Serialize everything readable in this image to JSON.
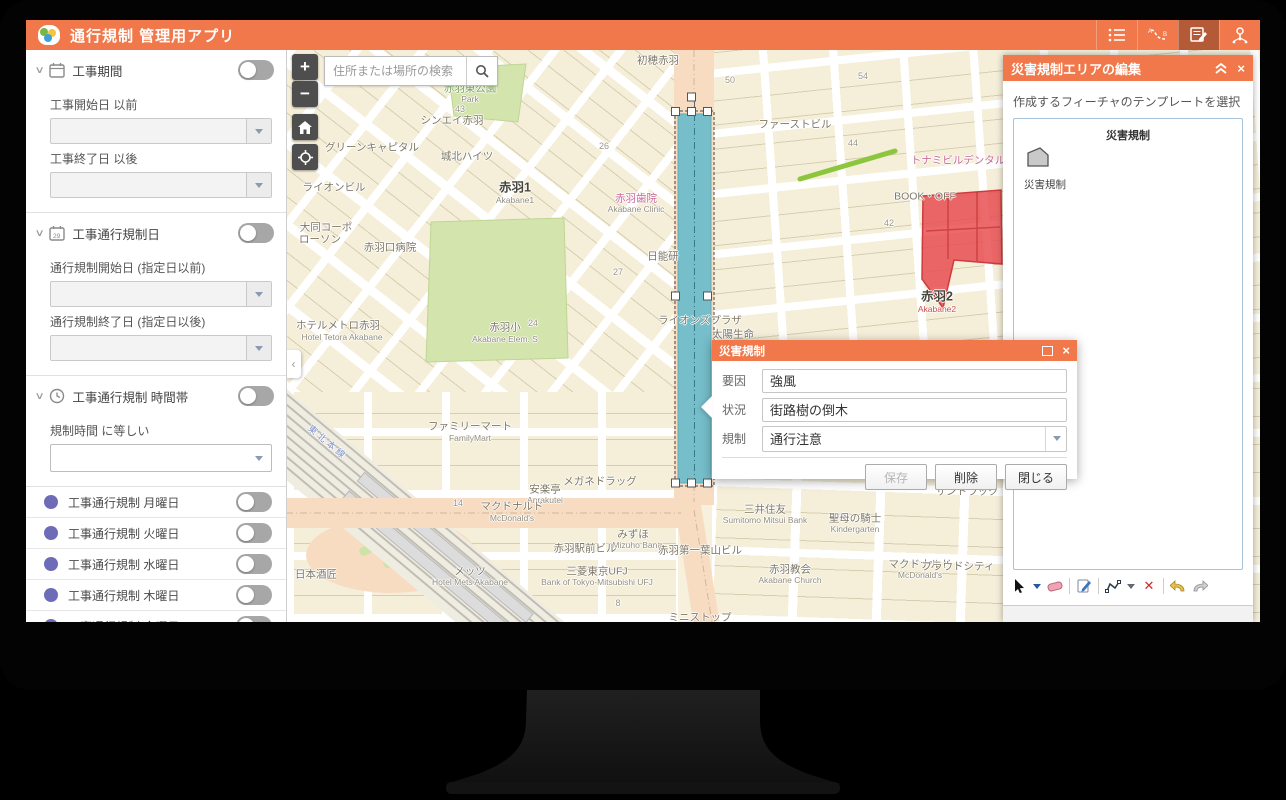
{
  "header": {
    "title": "通行規制 管理用アプリ",
    "icons": [
      "legend-list",
      "route-ab",
      "edit-plan",
      "network-pin"
    ],
    "active_icon": "edit-plan"
  },
  "colors": {
    "accent_orange": "#F0784A",
    "weekday_purple": "#6E6CB8",
    "weekend_red": "#F2646E",
    "selection_teal": "#5FB9CC",
    "hazard_red": "#E8484C",
    "feature_green": "#8CC63E"
  },
  "sidebar": {
    "sections": [
      {
        "title": "工事期間",
        "icon": "calendar-icon",
        "fields": [
          "工事開始日 以前",
          "工事終了日 以後"
        ]
      },
      {
        "title": "工事通行規制日",
        "icon": "calendar-date-icon",
        "fields": [
          "通行規制開始日 (指定日以前)",
          "通行規制終了日 (指定日以後)"
        ]
      },
      {
        "title": "工事通行規制 時間帯",
        "icon": "clock-icon",
        "fields": [
          "規制時間 に等しい"
        ]
      }
    ],
    "days": [
      {
        "label": "工事通行規制 月曜日",
        "c": "purple"
      },
      {
        "label": "工事通行規制 火曜日",
        "c": "purple"
      },
      {
        "label": "工事通行規制 水曜日",
        "c": "purple"
      },
      {
        "label": "工事通行規制 木曜日",
        "c": "purple"
      },
      {
        "label": "工事通行規制 金曜日",
        "c": "purple"
      },
      {
        "label": "工事通行規制 土曜日",
        "c": "red"
      },
      {
        "label": "工事通行規制 日曜日",
        "c": "red"
      }
    ]
  },
  "map": {
    "search_placeholder": "住所または場所の検索",
    "labels": [
      {
        "t": "初穂赤羽",
        "x": 372,
        "y": 10
      },
      {
        "t": "赤羽東公園",
        "x": 184,
        "y": 38,
        "c": "green"
      },
      {
        "t": "Park",
        "x": 184,
        "y": 49,
        "c": "en"
      },
      {
        "t": "43",
        "x": 174,
        "y": 59,
        "c": "num"
      },
      {
        "t": "シンエイ赤羽",
        "x": 166,
        "y": 70
      },
      {
        "t": "グリーンキャピタル",
        "x": 86,
        "y": 97
      },
      {
        "t": "城北ハイツ",
        "x": 181,
        "y": 106
      },
      {
        "t": "ライオンビル",
        "x": 48,
        "y": 137
      },
      {
        "t": "赤羽1",
        "x": 229,
        "y": 136,
        "c": "bold"
      },
      {
        "t": "Akabane1",
        "x": 229,
        "y": 150,
        "c": "en"
      },
      {
        "t": "大同コーポ",
        "x": 40,
        "y": 177
      },
      {
        "t": "ローソン",
        "x": 34,
        "y": 189
      },
      {
        "t": "赤羽口病院",
        "x": 104,
        "y": 197
      },
      {
        "t": "赤羽歯院",
        "x": 350,
        "y": 148,
        "c": "pink"
      },
      {
        "t": "Akabane Clinic",
        "x": 350,
        "y": 159,
        "c": "en"
      },
      {
        "t": "日能研",
        "x": 377,
        "y": 206
      },
      {
        "t": "ファーストビル",
        "x": 509,
        "y": 74
      },
      {
        "t": "44",
        "x": 567,
        "y": 93,
        "c": "num"
      },
      {
        "t": "BOOK・OFF",
        "x": 639,
        "y": 146
      },
      {
        "t": "トナミビルデンタル",
        "x": 672,
        "y": 110,
        "c": "pink"
      },
      {
        "t": "赤羽2",
        "x": 651,
        "y": 245,
        "c": "bold"
      },
      {
        "t": "Akabane2",
        "x": 651,
        "y": 259,
        "c": "en-red"
      },
      {
        "t": "ライオンズプラザ",
        "x": 414,
        "y": 270
      },
      {
        "t": "太陽生命",
        "x": 447,
        "y": 284
      },
      {
        "t": "赤羽小",
        "x": 219,
        "y": 277
      },
      {
        "t": "24",
        "x": 247,
        "y": 273,
        "c": "num"
      },
      {
        "t": "Akabane Elem. S",
        "x": 219,
        "y": 289,
        "c": "en"
      },
      {
        "t": "ホテルメトロ赤羽",
        "x": 52,
        "y": 275
      },
      {
        "t": "Hotel Tetora Akabane",
        "x": 56,
        "y": 287,
        "c": "en"
      },
      {
        "t": "東北本線",
        "x": 42,
        "y": 392,
        "c": "rail"
      },
      {
        "t": "ファミリーマート",
        "x": 184,
        "y": 376
      },
      {
        "t": "FamilyMart",
        "x": 184,
        "y": 388,
        "c": "en"
      },
      {
        "t": "メガネドラッグ",
        "x": 314,
        "y": 431
      },
      {
        "t": "安楽亭",
        "x": 259,
        "y": 439
      },
      {
        "t": "Anrakutei",
        "x": 259,
        "y": 450,
        "c": "en"
      },
      {
        "t": "マクドナルド",
        "x": 226,
        "y": 456
      },
      {
        "t": "McDonald's",
        "x": 226,
        "y": 468,
        "c": "en"
      },
      {
        "t": "14",
        "x": 172,
        "y": 453,
        "c": "num"
      },
      {
        "t": "みずほ",
        "x": 347,
        "y": 484
      },
      {
        "t": "Mizuho Bank",
        "x": 351,
        "y": 495,
        "c": "en"
      },
      {
        "t": "赤羽駅前ビル",
        "x": 299,
        "y": 498
      },
      {
        "t": "赤羽第一葉山ビル",
        "x": 414,
        "y": 500
      },
      {
        "t": "三菱東京UFJ",
        "x": 311,
        "y": 521
      },
      {
        "t": "Bank of Tokyo-Mitsubishi UFJ",
        "x": 311,
        "y": 532,
        "c": "en"
      },
      {
        "t": "メッツ",
        "x": 184,
        "y": 521
      },
      {
        "t": "Hotel Mets Akabane",
        "x": 184,
        "y": 532,
        "c": "en"
      },
      {
        "t": "日本酒匠",
        "x": 30,
        "y": 524
      },
      {
        "t": "ミニストップ",
        "x": 414,
        "y": 567
      },
      {
        "t": "7",
        "x": 374,
        "y": 497,
        "c": "num"
      },
      {
        "t": "8",
        "x": 332,
        "y": 553,
        "c": "num"
      },
      {
        "t": "サントラック",
        "x": 681,
        "y": 441
      },
      {
        "t": "三井住友",
        "x": 479,
        "y": 459
      },
      {
        "t": "Sumitomo Mitsui Bank",
        "x": 479,
        "y": 470,
        "c": "en"
      },
      {
        "t": "聖母の騎士",
        "x": 569,
        "y": 468
      },
      {
        "t": "Kindergarten",
        "x": 569,
        "y": 479,
        "c": "en"
      },
      {
        "t": "赤羽教会",
        "x": 504,
        "y": 519
      },
      {
        "t": "Akabane Church",
        "x": 504,
        "y": 530,
        "c": "en"
      },
      {
        "t": "マクドナルド",
        "x": 634,
        "y": 514
      },
      {
        "t": "McDonald's",
        "x": 634,
        "y": 525,
        "c": "en"
      },
      {
        "t": "プラウドシティ",
        "x": 672,
        "y": 516
      },
      {
        "t": "50",
        "x": 444,
        "y": 30,
        "c": "num"
      },
      {
        "t": "54",
        "x": 577,
        "y": 26,
        "c": "num"
      },
      {
        "t": "26",
        "x": 318,
        "y": 96,
        "c": "num"
      },
      {
        "t": "27",
        "x": 332,
        "y": 222,
        "c": "num"
      },
      {
        "t": "42",
        "x": 603,
        "y": 173,
        "c": "num"
      }
    ]
  },
  "right_panel": {
    "title": "災害規制エリアの編集",
    "subtitle": "作成するフィーチャのテンプレートを選択",
    "group_title": "災害規制",
    "template_label": "災害規制",
    "toolbar_icons": [
      "select-arrow",
      "eraser",
      "edit-attributes",
      "reshape-polyline",
      "delete-x",
      "undo",
      "redo"
    ]
  },
  "dialog": {
    "title": "災害規制",
    "fields": [
      {
        "label": "要因",
        "value": "強風"
      },
      {
        "label": "状況",
        "value": "街路樹の倒木"
      },
      {
        "label": "規制",
        "value": "通行注意"
      }
    ],
    "buttons": {
      "save": "保存",
      "delete": "削除",
      "close": "閉じる"
    }
  }
}
